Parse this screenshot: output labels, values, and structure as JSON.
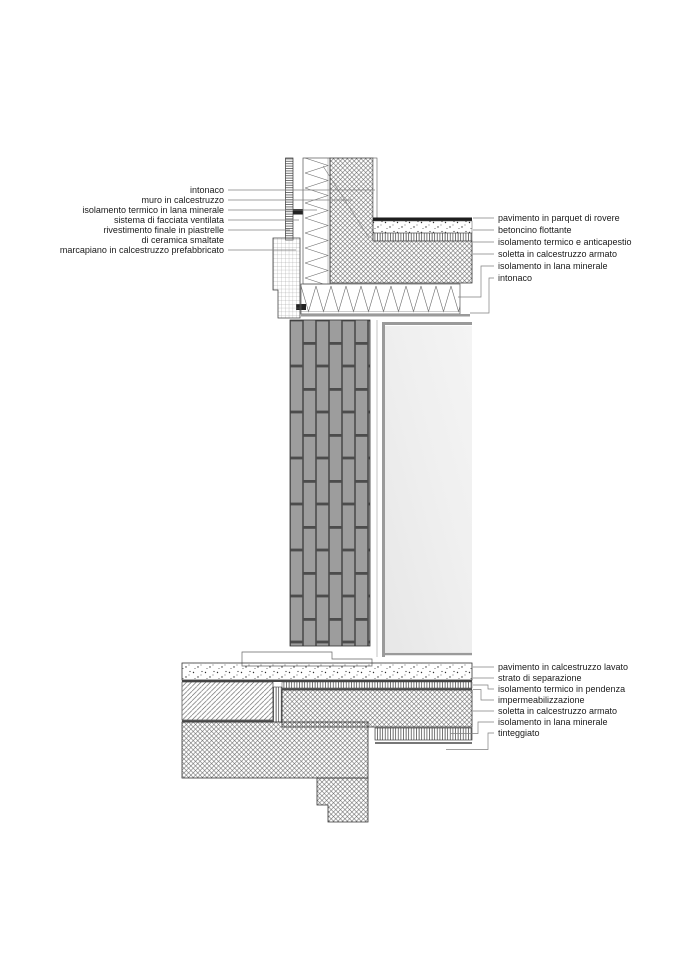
{
  "labels": {
    "left": [
      "intonaco",
      "muro in calcestruzzo",
      "isolamento termico in lana minerale",
      "sistema di facciata ventilata",
      "rivestimento finale in piastrelle",
      "di ceramica smaltate",
      "marcapiano in calcestruzzo prefabbricato"
    ],
    "right_top": [
      "pavimento in parquet di rovere",
      "betoncino flottante",
      "isolamento termico e anticapestio",
      "soletta in calcestruzzo armato",
      "isolamento in lana minerale",
      "intonaco"
    ],
    "right_bottom": [
      "pavimento in calcestruzzo lavato",
      "strato di separazione",
      "isolamento termico in pendenza",
      "impermeabilizzazione",
      "soletta in calcestruzzo armato",
      "isolamento in lana minerale",
      "tinteggiato"
    ]
  },
  "colors": {
    "brick": "#9d9d9d",
    "brick_joint": "#4c4c4c",
    "glass": "#ededed",
    "parquet": "#1e1e1e",
    "line": "#333333",
    "leader": "#808080",
    "intonaco_line": "#9a9a9a"
  }
}
